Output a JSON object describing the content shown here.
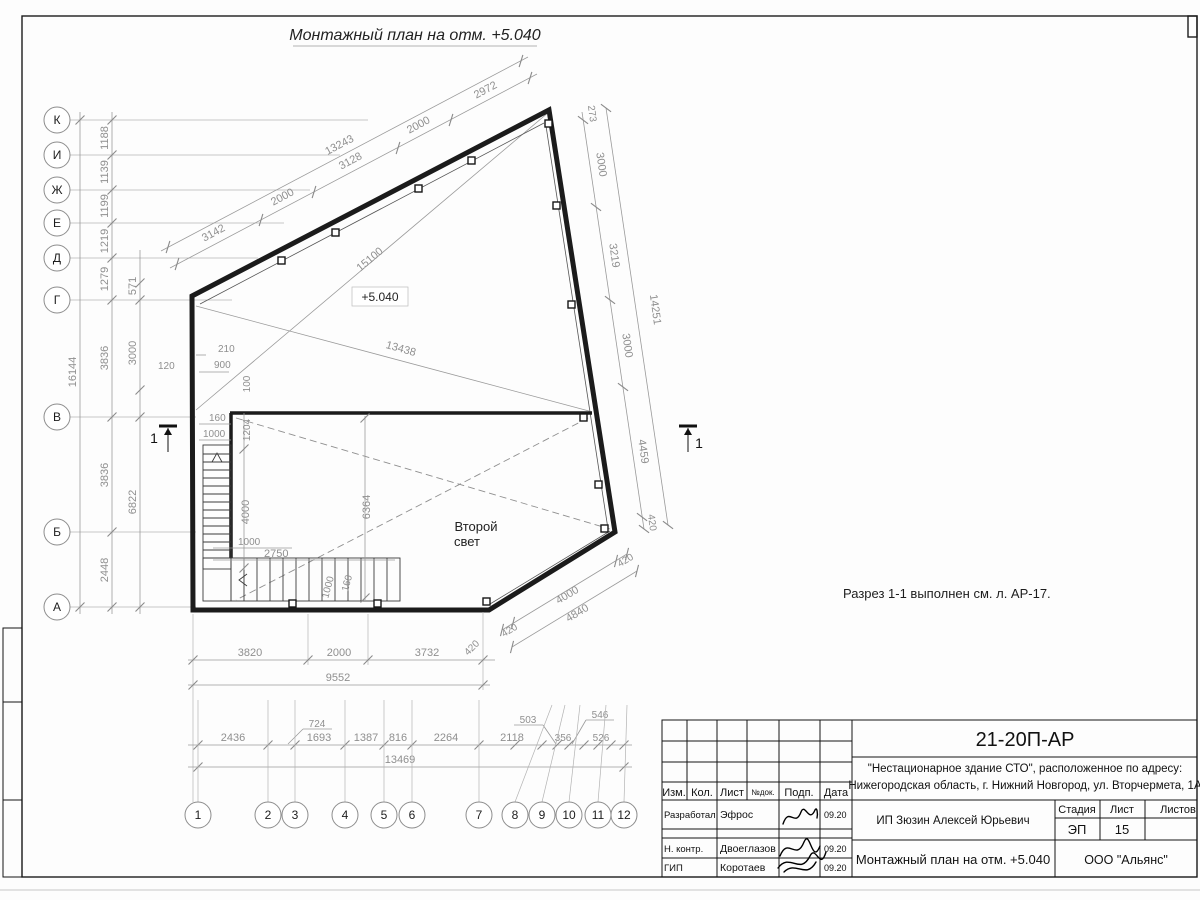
{
  "title": "Монтажный план на отм. +5.040",
  "note": "Разрез 1-1 выполнен см. л. АР-17.",
  "level_mark": "+5.040",
  "room_label_line1": "Второй",
  "room_label_line2": "свет",
  "section_number": "1",
  "axes": {
    "rows": [
      "К",
      "И",
      "Ж",
      "Е",
      "Д",
      "Г",
      "В",
      "Б",
      "А"
    ],
    "cols": [
      "1",
      "2",
      "3",
      "4",
      "5",
      "6",
      "7",
      "8",
      "9",
      "10",
      "11",
      "12"
    ]
  },
  "dims": {
    "d16144": "16144",
    "d1188": "1188",
    "d1139": "1139",
    "d1199": "1199",
    "d1219": "1219",
    "d1279": "1279",
    "d571": "571",
    "d3836": "3836",
    "d3000": "3000",
    "d6822": "6822",
    "d2448": "2448",
    "d120": "120",
    "d3142": "3142",
    "d2000": "2000",
    "d3128": "3128",
    "d2972": "2972",
    "d13243": "13243",
    "d15100": "15100",
    "d273": "273",
    "d3219": "3219",
    "d14251": "14251",
    "d4459": "4459",
    "d420": "420",
    "d13438": "13438",
    "d210": "210",
    "d900": "900",
    "d100": "100",
    "d160": "160",
    "d1000": "1000",
    "d1204": "1204",
    "d4000": "4000",
    "d6364": "6364",
    "d2750": "2750",
    "d4840": "4840",
    "d3820": "3820",
    "d3732": "3732",
    "d9552": "9552",
    "d2436": "2436",
    "d724": "724",
    "d1693": "1693",
    "d1387": "1387",
    "d816": "816",
    "d2264": "2264",
    "d2118": "2118",
    "d503": "503",
    "d356": "356",
    "d546": "546",
    "d526": "526",
    "d13469": "13469"
  },
  "title_block": {
    "doc_number": "21-20П-АР",
    "address_line1": "\"Нестационарное здание СТО\", расположенное по адресу:",
    "address_line2": "Нижегородская область, г. Нижний Новгород, ул. Вторчермета, 1А",
    "client": "ИП Зюзин Алексей Юрьевич",
    "sheet_title": "Монтажный план на отм. +5.040",
    "company": "ООО \"Альянс\"",
    "headers": {
      "izm": "Изм.",
      "kol": "Кол.",
      "list": "Лист",
      "ndok": "№док.",
      "podp": "Подп.",
      "data": "Дата",
      "stage": "Стадия",
      "sheet": "Лист",
      "sheets": "Листов"
    },
    "stage_value": "ЭП",
    "sheet_value": "15",
    "rows": [
      {
        "role": "Разработал",
        "name": "Эфрос",
        "date": "09.20"
      },
      {
        "role": "Н. контр.",
        "name": "Двоеглазов",
        "date": "09.20"
      },
      {
        "role": "ГИП",
        "name": "Коротаев",
        "date": "09.20"
      }
    ]
  }
}
